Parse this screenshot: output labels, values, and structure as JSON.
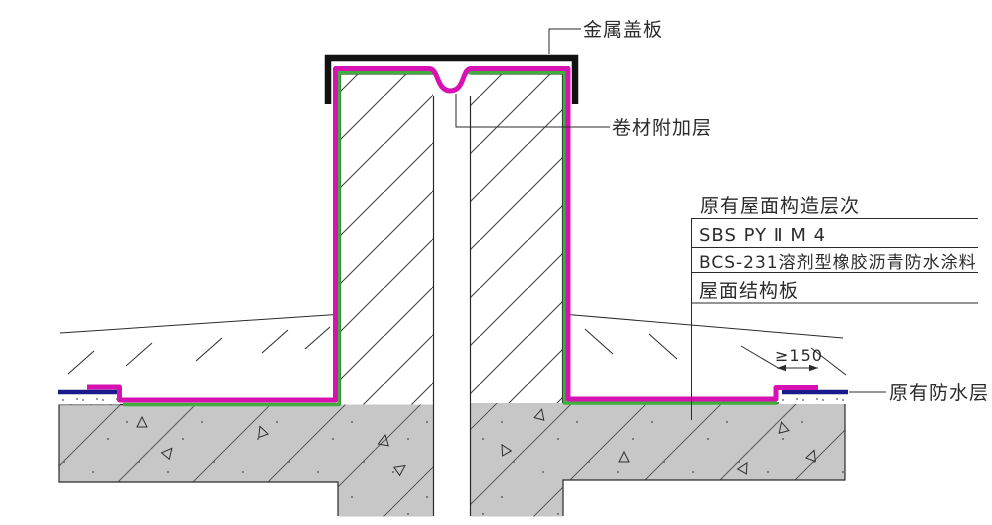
{
  "drawing": {
    "labels": {
      "metal_cover_plate": "金属盖板",
      "membrane_additional_layer": "卷材附加层",
      "existing_waterproof_layer": "原有防水层"
    },
    "layers_table": {
      "title": "原有屋面构造层次",
      "rows": [
        "SBS PY Ⅱ M 4",
        "BCS-231溶剂型橡胶沥青防水涂料",
        "屋面结构板"
      ]
    },
    "dimension": {
      "min_lap": "≥150"
    },
    "colors": {
      "membrane_magenta": "#d812b2",
      "coating_green": "#3fae3f",
      "existing_membrane_blue": "#1a1a8c",
      "concrete_gray": "#c7c7c7",
      "line_black": "#2a2a2a"
    }
  }
}
